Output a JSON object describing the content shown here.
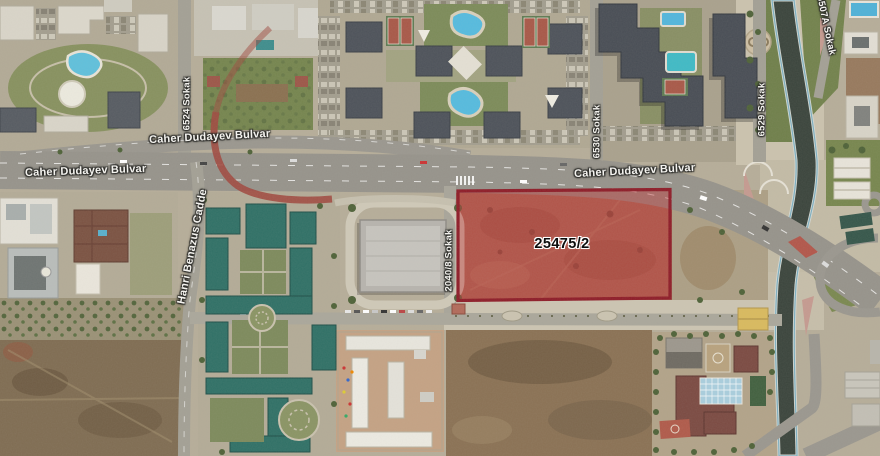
{
  "map": {
    "type": "satellite-imagery-with-parcel-overlay",
    "parcel": {
      "id": "25475/2",
      "fill_color": "#c03939",
      "border_color": "#8e1c28"
    },
    "road_labels": [
      {
        "text": "Caher Dudayev Bulvar"
      },
      {
        "text": "Caher Dudayev Bulvar"
      },
      {
        "text": "Caher Dudayev Bulvar"
      },
      {
        "text": "Hanri Benazus Cadde"
      },
      {
        "text": "2040/8 Sokak"
      },
      {
        "text": "6524 Sokak"
      },
      {
        "text": "6530 Sokak"
      },
      {
        "text": "6529 Sokak"
      },
      {
        "text": "6507A Sokak"
      }
    ]
  }
}
